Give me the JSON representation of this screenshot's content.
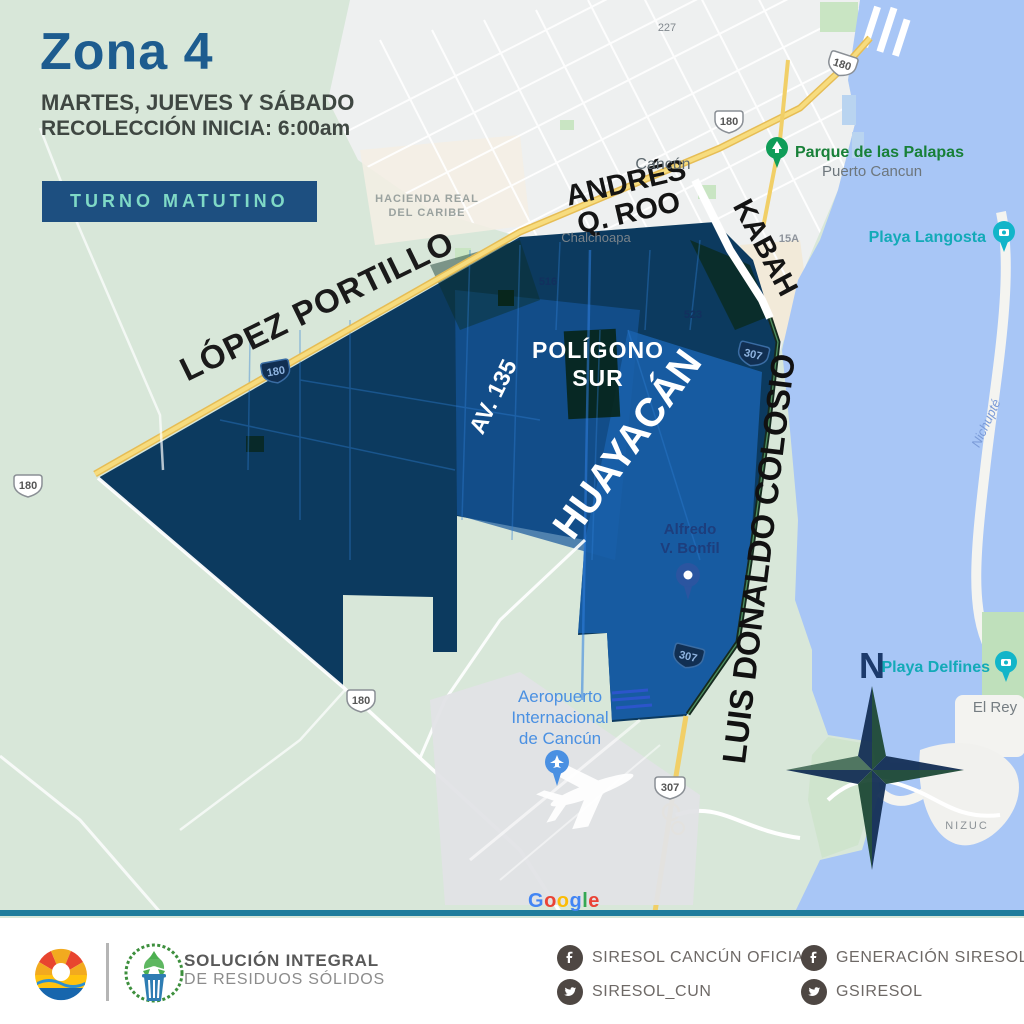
{
  "header": {
    "title": "Zona 4",
    "schedule_days": "MARTES, JUEVES Y SÁBADO",
    "collection_start": "RECOLECCIÓN INICIA: 6:00am",
    "shift_badge": "TURNO MATUTINO"
  },
  "map": {
    "streets": {
      "lopez_portillo": "LÓPEZ PORTILLO",
      "andres_line1": "ANDRÉS",
      "andres_line2": "Q. ROO",
      "kabah": "KABAH",
      "av135": "AV. 135",
      "huayacan": "HUAYACÁN",
      "colosio": "LUIS DONALDO COLOSIO"
    },
    "zone_label_line1": "POLÍGONO",
    "zone_label_line2": "SUR",
    "places": {
      "cancun": "Cancún",
      "chalchoapa": "Chalchoapa",
      "hacienda_line1": "HACIENDA REAL",
      "hacienda_line2": "DEL CARIBE",
      "parque_palapas": "Parque de las Palapas",
      "puerto_cancun": "Puerto Cancun",
      "playa_langosta": "Playa Langosta",
      "playa_delfines": "Playa Delfines",
      "el_rey": "El Rey",
      "nizuc": "NIZUC",
      "nichupte": "Nichupté",
      "bonfil_line1": "Alfredo",
      "bonfil_line2": "V. Bonfil",
      "airport_line1": "Aeropuerto",
      "airport_line2": "Internacional",
      "airport_line3": "de Cancún"
    },
    "road_numbers": {
      "n180": "180",
      "n307": "307",
      "n15a": "15A",
      "n227": "227",
      "n516": "516",
      "n523": "523"
    },
    "compass_north": "N",
    "google_letters": [
      "G",
      "o",
      "o",
      "g",
      "l",
      "e"
    ]
  },
  "footer": {
    "org_line1": "SOLUCIÓN INTEGRAL",
    "org_line2": "DE RESIDUOS SÓLIDOS",
    "social": {
      "facebook_1": "SIRESOL CANCÚN OFICIAL",
      "facebook_2": "GENERACIÓN SIRESOL",
      "twitter_1": "SIRESOL_CUN",
      "twitter_2": "GSIRESOL"
    }
  },
  "colors": {
    "title_blue": "#1d5c8f",
    "badge_bg": "#1d4f80",
    "badge_text": "#7fd9c6",
    "zone_fill": "#0c3a5f",
    "zone_highlight": "#1a62ad",
    "water": "#a8c6f6",
    "land": "#d8e7d9",
    "city": "#eef0f0",
    "road_yellow": "#f1cf67",
    "poi_green": "#188038",
    "poi_teal": "#13aab8"
  }
}
